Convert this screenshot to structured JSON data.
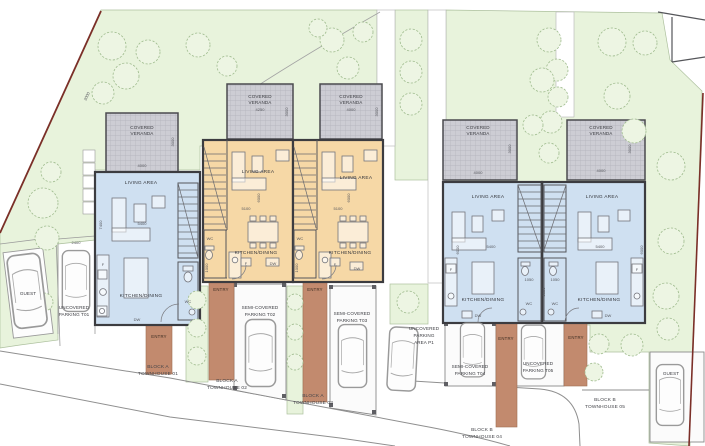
{
  "site": {
    "boundary_dim": "3000",
    "lot_width_dim": "2400",
    "guest_left_label": "GUEST",
    "guest_right_label": "GUEST",
    "p1_lines": [
      "UNCOVERED",
      "PARKING",
      "AREA P1"
    ]
  },
  "units": [
    {
      "block_lines": [
        "BLOCK A",
        "TOWNHOUSE 01"
      ],
      "veranda_lines": [
        "COVERED",
        "VERANDA"
      ],
      "veranda_width_dim": "4000",
      "veranda_depth_dim": "3000",
      "living_label": "LIVING AREA",
      "kitchen_label": "KITCHEN/DINING",
      "wc_label": "WC",
      "fridge_label": "F",
      "dishwasher_label": "DW",
      "entry_label": "ENTRY",
      "width_dim": "5400",
      "depth_dim": "7400",
      "parking_lines": [
        "UNCOVERED",
        "PARKING T01"
      ]
    },
    {
      "block_lines": [
        "BLOCK A",
        "TOWNHOUSE 02"
      ],
      "veranda_lines": [
        "COVERED",
        "VERANDA"
      ],
      "veranda_width_dim": "4250",
      "veranda_depth_dim": "3000",
      "living_label": "LIVING AREA",
      "kitchen_label": "KITCHEN/DINING",
      "wc_label": "WC",
      "fridge_label": "F",
      "dishwasher_label": "DW",
      "entry_label": "ENTRY",
      "width_dim": "5100",
      "depth_dim": "6000",
      "wc_width_dim": "1000",
      "parking_lines": [
        "SEMI-COVERED",
        "PARKING T02"
      ]
    },
    {
      "block_lines": [
        "BLOCK A",
        "TOWNHOUSE 03"
      ],
      "veranda_lines": [
        "COVERED",
        "VERANDA"
      ],
      "veranda_width_dim": "4000",
      "veranda_depth_dim": "3000",
      "living_label": "LIVING AREA",
      "kitchen_label": "KITCHEN/DINING",
      "wc_label": "WC",
      "fridge_label": "F",
      "dishwasher_label": "DW",
      "entry_label": "ENTRY",
      "width_dim": "5100",
      "depth_dim": "6000",
      "wc_width_dim": "1000",
      "parking_lines": [
        "SEMI-COVERED",
        "PARKING T03"
      ]
    },
    {
      "block_lines": [
        "BLOCK B",
        "TOWNHOUSE 04"
      ],
      "veranda_lines": [
        "COVERED",
        "VERANDA"
      ],
      "veranda_width_dim": "4000",
      "veranda_depth_dim": "3000",
      "living_label": "LIVING AREA",
      "kitchen_label": "KITCHEN/DINING",
      "wc_label": "WC",
      "fridge_label": "F",
      "dishwasher_label": "DW",
      "entry_label": "ENTRY",
      "width_dim": "5400",
      "depth_dim": "6000",
      "wc_width_dim": "1050",
      "wc_depth_dim": "3050",
      "parking_lines": [
        "SEMI-COVERED",
        "PARKING T04"
      ]
    },
    {
      "block_lines": [
        "BLOCK B",
        "TOWNHOUSE 05"
      ],
      "veranda_lines": [
        "COVERED",
        "VERANDA"
      ],
      "veranda_width_dim": "4000",
      "veranda_depth_dim": "3000",
      "living_label": "LIVING AREA",
      "kitchen_label": "KITCHEN/DINING",
      "wc_label": "WC",
      "fridge_label": "F",
      "dishwasher_label": "DW",
      "entry_label": "ENTRY",
      "width_dim": "5400",
      "depth_dim": "6000",
      "wc_width_dim": "1050",
      "parking_lines": [
        "UNCOVERED",
        "PARKING T05"
      ]
    }
  ]
}
